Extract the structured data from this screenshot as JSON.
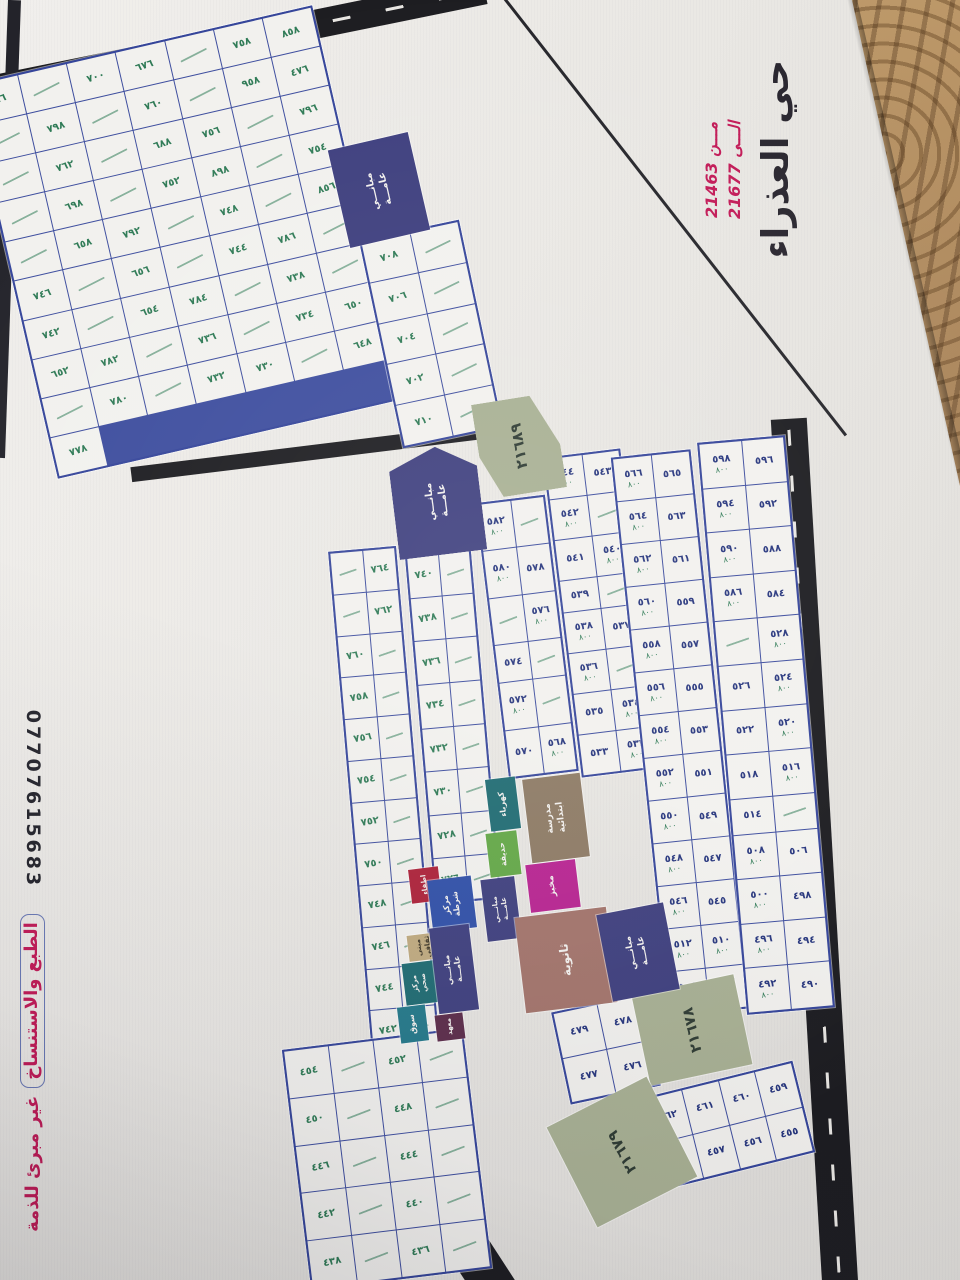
{
  "title_block": {
    "district_name": "حي العذراء",
    "from_label": "مـــن",
    "from_number": "21463",
    "to_label": "الـــى",
    "to_number": "21677"
  },
  "side_notes": {
    "phone": "07707615683",
    "disclaimer_boxed": "الطبع والاستنساخ",
    "disclaimer_rest": "غير مبرئ للذمة"
  },
  "roads": {
    "main_road_label": "شارع ١٠٠م"
  },
  "zones": {
    "z21689": {
      "label": "٢١٦٨٩"
    },
    "z21678": {
      "label": "٢١٦٧٨"
    },
    "z21679": {
      "label": "٢١٦٧٩"
    }
  },
  "facilities": {
    "public_buildings_top": {
      "label": "مبانـــي عامـــة"
    },
    "public_buildings_mid": {
      "label": "مبانـــي عامـــة"
    },
    "public_buildings_small": {
      "label": "مبانـــي عامـــة"
    },
    "public_buildings_center": {
      "label": "مبانـــي عامـــة"
    },
    "public_buildings_right": {
      "label": "مبانـــي عامـــة"
    },
    "electricity": {
      "label": "كهرباء"
    },
    "park": {
      "label": "حديقة"
    },
    "primary_school": {
      "label": "مدرسة ابتدائية"
    },
    "bakery": {
      "label": "مخبز"
    },
    "secondary_school": {
      "label": "ثانوية"
    },
    "fire_station": {
      "label": "اطفاء"
    },
    "police_station": {
      "label": "مركز شرطة"
    },
    "cultural_building": {
      "label": "مبنى ثقافي"
    },
    "health_center": {
      "label": "مركز صحي"
    },
    "market": {
      "label": "سوق"
    },
    "institute": {
      "label": "معهد"
    }
  },
  "blocks": {
    "A": {
      "ink": "green",
      "cells": [
        "٧٦٦",
        "",
        "٧٠٠",
        "٦٧٦",
        "",
        "٧٥٨",
        "٨٥٨",
        "",
        "٧٩٨",
        "",
        "٧٦٠",
        "",
        "٩٥٨",
        "٤٧٦",
        "",
        "٧٦٢",
        "",
        "٦٨٨",
        "٧٥٦",
        "",
        "٧٩٦",
        "",
        "٦٩٨",
        "",
        "٧٥٢",
        "٨٩٨",
        "",
        "٧٥٤",
        "",
        "٦٥٨",
        "٧٩٢",
        "",
        "٧٤٨",
        "",
        "٨٥٦",
        "٧٤٦",
        "",
        "٦٥٦",
        "",
        "٧٤٤",
        "٧٨٦",
        "",
        "٧٤٢",
        "",
        "٦٥٤",
        "٧٨٤",
        "",
        "٧٣٨",
        "",
        "٦٥٢",
        "٧٨٢",
        "",
        "٧٣٦",
        "",
        "٧٣٤",
        "٦٥٠",
        "",
        "٧٨٠",
        "",
        "٧٣٢",
        "٧٣٠",
        "",
        "٦٤٨",
        "٧٧٨"
      ]
    },
    "B0": {
      "ink": "green",
      "cells": [
        "٧٠٨",
        "",
        "٧٠٦",
        "",
        "٧٠٤",
        "",
        "٧٠٢",
        "",
        "٧١٠",
        ""
      ]
    },
    "B1": {
      "ink": "green",
      "cells": [
        "",
        "٧٦٤",
        "",
        "٧٦٢",
        "٧٦٠",
        "",
        "٧٥٨",
        "",
        "٧٥٦",
        "",
        "٧٥٤",
        "",
        "٧٥٢",
        "",
        "٧٥٠",
        "",
        "٧٤٨",
        "",
        "٧٤٦",
        "",
        "٧٤٤",
        "",
        "٧٤٢",
        ""
      ]
    },
    "B2": {
      "ink": "green",
      "cells": [
        "٧٤٠",
        "",
        "٧٣٨",
        "",
        "٧٣٦",
        "",
        "٧٣٤",
        "",
        "٧٣٢",
        "",
        "٧٣٠",
        "",
        "٧٢٨",
        "",
        "٧٢٦",
        ""
      ]
    },
    "C1": {
      "ink": "blue",
      "cells": [
        "٥٨٢|٨٠٠",
        "",
        "٥٨٠|٨٠٠",
        "٥٧٨|",
        "",
        "٥٧٦|٨٠٠",
        "٥٧٤|",
        "",
        "٥٧٢|٨٠٠",
        "",
        "٥٧٠|",
        "٥٦٨|٨٠٠"
      ]
    },
    "C2": {
      "ink": "blue",
      "cells": [
        "٥٤٤|٨٠٠",
        "٥٤٣|",
        "٥٤٢|٨٠٠",
        "",
        "٥٤١|",
        "٥٤٠|٨٠٠",
        "٥٣٩|",
        "",
        "٥٣٨|٨٠٠",
        "٥٣٧|",
        "٥٣٦|٨٠٠",
        "",
        "٥٣٥|",
        "٥٣٤|٨٠٠",
        "٥٣٣|",
        "٥٣٢|٨٠٠"
      ]
    },
    "C3": {
      "ink": "blue",
      "cells": [
        "٥٦٦|٨٠٠",
        "٥٦٥|",
        "٥٦٤|٨٠٠",
        "٥٦٣|",
        "٥٦٢|٨٠٠",
        "٥٦١|",
        "٥٦٠|٨٠٠",
        "٥٥٩|",
        "٥٥٨|٨٠٠",
        "٥٥٧|",
        "٥٥٦|٨٠٠",
        "٥٥٥|",
        "٥٥٤|٨٠٠",
        "٥٥٣|",
        "٥٥٢|٨٠٠",
        "٥٥١|",
        "٥٥٠|٨٠٠",
        "٥٤٩|",
        "٥٤٨|٨٠٠",
        "٥٤٧|",
        "٥٤٦|٨٠٠",
        "٥٤٥|",
        "٥١٢|٨٠٠",
        "٥١٠|٨٠٠",
        "٥٠٤|٨٠٠",
        "٥٠٢|٨٠٠"
      ]
    },
    "C4": {
      "ink": "blue",
      "cells": [
        "٥٩٨|٨٠٠",
        "٥٩٦|",
        "٥٩٤|٨٠٠",
        "٥٩٢|",
        "٥٩٠|٨٠٠",
        "٥٨٨|",
        "٥٨٦|٨٠٠",
        "٥٨٤|",
        "",
        "٥٢٨|٨٠٠",
        "٥٢٦|",
        "٥٢٤|٨٠٠",
        "٥٢٢|",
        "٥٢٠|٨٠٠",
        "٥١٨|",
        "٥١٦|٨٠٠",
        "٥١٤|",
        "",
        "٥٠٨|٨٠٠",
        "٥٠٦|",
        "٥٠٠|٨٠٠",
        "٤٩٨|",
        "٤٩٦|٨٠٠",
        "٤٩٤|",
        "٤٩٢|٨٠٠",
        "٤٩٠|"
      ]
    },
    "D1": {
      "ink": "blue",
      "cells": [
        "٤٧٩|",
        "٤٧٨|",
        "٤٧٧|",
        "٤٧٦|"
      ]
    },
    "D2": {
      "ink": "blue",
      "cells": [
        "٤٦٢|",
        "٤٦١|",
        "٤٦٠|",
        "٤٥٩|",
        "٤٥٨|",
        "٤٥٧|",
        "٤٥٦|",
        "٤٥٥|"
      ]
    },
    "E": {
      "ink": "green",
      "cells": [
        "٤٥٤|",
        "",
        "٤٥٢|",
        "",
        "٤٥٠|",
        "",
        "٤٤٨|",
        "",
        "٤٤٦|",
        "",
        "٤٤٤|",
        "",
        "٤٤٢|",
        "",
        "٤٤٠|",
        "",
        "٤٣٨|",
        "",
        "٤٣٦|",
        ""
      ]
    }
  },
  "colors": {
    "accent_magenta": "#c21a57",
    "ink_blue": "#26357d",
    "ink_green": "#2e7a55",
    "road_black": "#1c1c20",
    "navy_block": "#3e3f7e",
    "olive_zone": "#a8b093",
    "teal_block": "#1e6b72",
    "green_park": "#63a846",
    "brown_school": "#8d7a64",
    "magenta_block": "#b82391",
    "rose_block": "#a3746b",
    "blue_police": "#2f4fa8",
    "red_fire": "#ad2038",
    "maroon_institute": "#5c2c4a",
    "tan_block": "#c0ab7f"
  }
}
